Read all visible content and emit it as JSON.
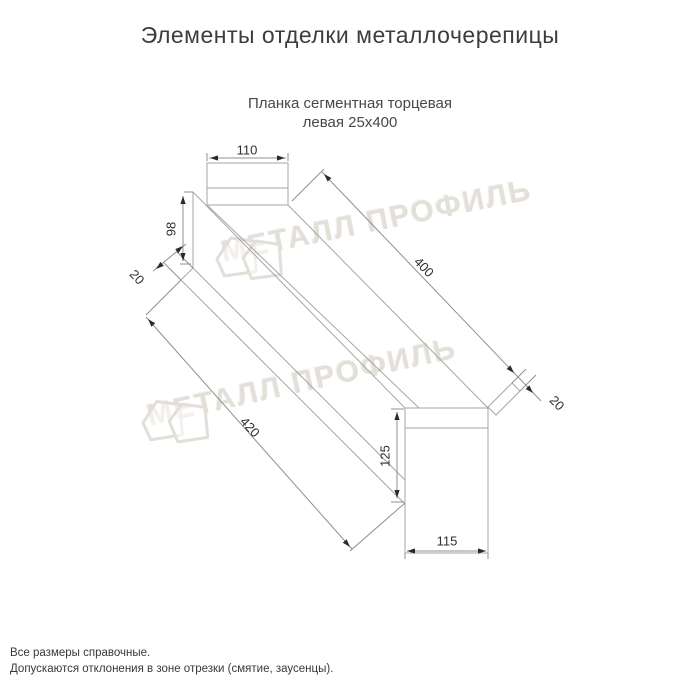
{
  "page": {
    "title": "Элементы отделки металлочерепицы",
    "product_name_line1": "Планка сегментная торцевая",
    "product_name_line2": "левая 25х400",
    "footnote_line1": "Все размеры справочные.",
    "footnote_line2": "Допускаются отклонения в зоне отрезки (смятие, заусенцы)."
  },
  "watermark": {
    "text": "МЕТАЛЛ ПРОФИЛЬ"
  },
  "drawing": {
    "type": "technical-dimension-drawing",
    "units": "mm",
    "dimensions": {
      "top_flange_width": "110",
      "left_end_web_height": "98",
      "left_end_kick": "20",
      "length_top_edge": "400",
      "length_bottom_edge": "420",
      "right_end_kick": "20",
      "right_end_web_height": "125",
      "bottom_flange_width": "115"
    },
    "colors": {
      "part_line": "#a6a6a6",
      "dimension_line": "#8f8f8f",
      "arrow": "#2a2a2a",
      "dimension_text": "#2f2f2f",
      "title_text": "#3d3d3d"
    }
  }
}
